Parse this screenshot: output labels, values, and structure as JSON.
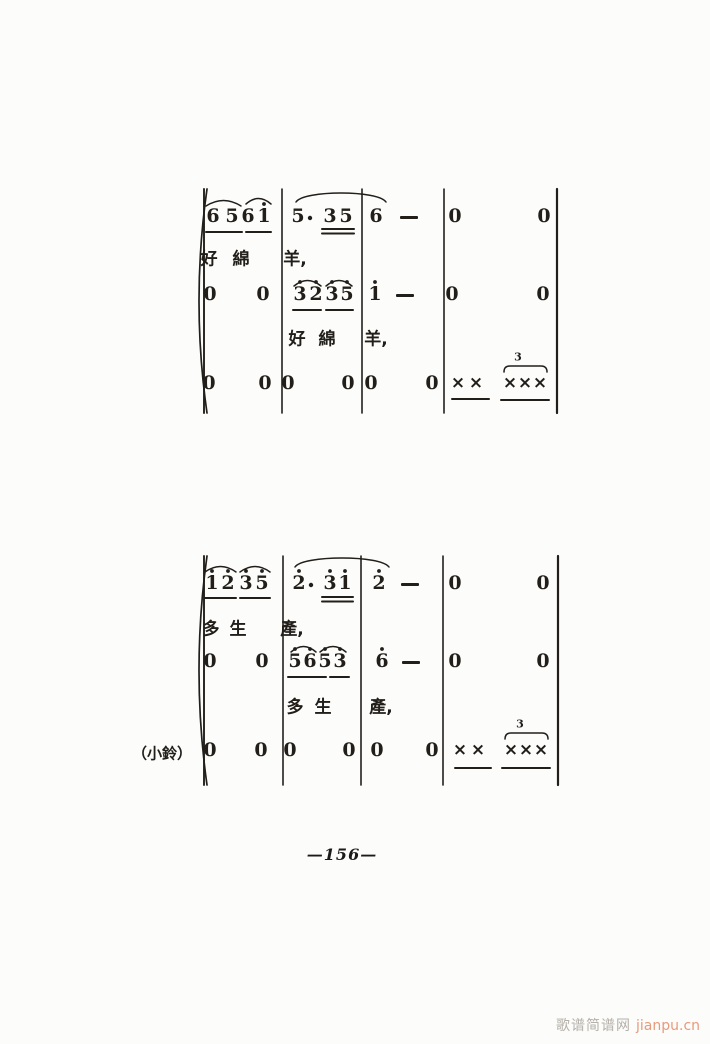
{
  "page": {
    "background": "#fcfcfa",
    "ink": "#221f1b",
    "page_number": "—156—",
    "watermark": {
      "site_name": "歌谱简谱网",
      "site_url": "jianpu.cn",
      "name_color": "#b5b0a9",
      "url_color": "#e89a7c"
    }
  },
  "systems": [
    {
      "name": "system-1",
      "top": 189,
      "bottom": 413,
      "brace_x": 196,
      "line_x": 204,
      "right_x": 557,
      "barlines": [
        282,
        362,
        444
      ],
      "label": null,
      "note_rows": [
        {
          "y": 216,
          "notes": [
            {
              "t": "6",
              "x": 213
            },
            {
              "t": "5",
              "x": 232
            },
            {
              "t": "6",
              "x": 248
            },
            {
              "t": "1",
              "x": 264,
              "d": true
            },
            {
              "t": "5",
              "x": 298,
              "aug": true
            },
            {
              "t": "3",
              "x": 330
            },
            {
              "t": "5",
              "x": 346
            },
            {
              "t": "6",
              "x": 376
            },
            {
              "t": "0",
              "x": 455
            },
            {
              "t": "0",
              "x": 544
            }
          ]
        },
        {
          "y": 294,
          "notes": [
            {
              "t": "0",
              "x": 210
            },
            {
              "t": "0",
              "x": 263
            },
            {
              "t": "3",
              "x": 300,
              "d": true
            },
            {
              "t": "2",
              "x": 316,
              "d": true
            },
            {
              "t": "3",
              "x": 332,
              "d": true
            },
            {
              "t": "5",
              "x": 347,
              "d": true
            },
            {
              "t": "1",
              "x": 375,
              "d": true
            },
            {
              "t": "0",
              "x": 452
            },
            {
              "t": "0",
              "x": 543
            }
          ]
        },
        {
          "y": 383,
          "notes": [
            {
              "t": "0",
              "x": 209
            },
            {
              "t": "0",
              "x": 265
            },
            {
              "t": "0",
              "x": 288
            },
            {
              "t": "0",
              "x": 348
            },
            {
              "t": "0",
              "x": 371
            },
            {
              "t": "0",
              "x": 432
            },
            {
              "t": "×",
              "x": 458
            },
            {
              "t": "×",
              "x": 476
            },
            {
              "t": "×",
              "x": 510
            },
            {
              "t": "×",
              "x": 525
            },
            {
              "t": "×",
              "x": 540
            }
          ]
        }
      ],
      "dashes": [
        {
          "x": 409,
          "y": 216
        },
        {
          "x": 405,
          "y": 294
        }
      ],
      "lyric_rows": [
        {
          "y": 257,
          "chars": [
            {
              "t": "好",
              "x": 209
            },
            {
              "t": "綿",
              "x": 241
            },
            {
              "t": "羊,",
              "x": 295
            }
          ]
        },
        {
          "y": 337,
          "chars": [
            {
              "t": "好",
              "x": 297
            },
            {
              "t": "綿",
              "x": 327
            },
            {
              "t": "羊,",
              "x": 376
            }
          ]
        }
      ],
      "slurs": [
        {
          "x1": 206,
          "x2": 241,
          "y": 197
        },
        {
          "x1": 246,
          "x2": 271,
          "y": 195
        },
        {
          "x1": 296,
          "x2": 386,
          "y": 190,
          "big": true
        },
        {
          "x1": 294,
          "x2": 321,
          "y": 277
        },
        {
          "x1": 326,
          "x2": 352,
          "y": 277
        }
      ],
      "underlines": [
        {
          "x1": 206,
          "x2": 242,
          "y": 232
        },
        {
          "x1": 246,
          "x2": 271,
          "y": 232
        },
        {
          "x1": 322,
          "x2": 354,
          "y": 229,
          "n": 2
        },
        {
          "x1": 293,
          "x2": 321,
          "y": 310
        },
        {
          "x1": 326,
          "x2": 353,
          "y": 310
        },
        {
          "x1": 452,
          "x2": 489,
          "y": 399
        },
        {
          "x1": 501,
          "x2": 549,
          "y": 400
        }
      ],
      "triplets": [
        {
          "x1": 504,
          "x2": 547,
          "y": 366,
          "label": "3",
          "lx": 518,
          "ly": 357
        }
      ]
    },
    {
      "name": "system-2",
      "top": 556,
      "bottom": 785,
      "brace_x": 196,
      "line_x": 204,
      "right_x": 558,
      "barlines": [
        283,
        361,
        443
      ],
      "label": {
        "text": "（小鈴）",
        "x": 162,
        "y": 753
      },
      "note_rows": [
        {
          "y": 583,
          "notes": [
            {
              "t": "1",
              "x": 212,
              "d": true
            },
            {
              "t": "2",
              "x": 228,
              "d": true
            },
            {
              "t": "3",
              "x": 246,
              "d": true
            },
            {
              "t": "5",
              "x": 262,
              "d": true
            },
            {
              "t": "2",
              "x": 299,
              "d": true,
              "aug": true
            },
            {
              "t": "3",
              "x": 330,
              "d": true
            },
            {
              "t": "1",
              "x": 345,
              "d": true
            },
            {
              "t": "2",
              "x": 379,
              "d": true
            },
            {
              "t": "0",
              "x": 455
            },
            {
              "t": "0",
              "x": 543
            }
          ]
        },
        {
          "y": 661,
          "notes": [
            {
              "t": "0",
              "x": 210
            },
            {
              "t": "0",
              "x": 262
            },
            {
              "t": "5",
              "x": 295,
              "d": true
            },
            {
              "t": "6",
              "x": 310,
              "d": true
            },
            {
              "t": "5",
              "x": 325,
              "d": true
            },
            {
              "t": "3",
              "x": 340,
              "d": true
            },
            {
              "t": "6",
              "x": 382,
              "d": true
            },
            {
              "t": "0",
              "x": 455
            },
            {
              "t": "0",
              "x": 543
            }
          ]
        },
        {
          "y": 750,
          "notes": [
            {
              "t": "0",
              "x": 210
            },
            {
              "t": "0",
              "x": 261
            },
            {
              "t": "0",
              "x": 290
            },
            {
              "t": "0",
              "x": 349
            },
            {
              "t": "0",
              "x": 377
            },
            {
              "t": "0",
              "x": 432
            },
            {
              "t": "×",
              "x": 460
            },
            {
              "t": "×",
              "x": 478
            },
            {
              "t": "×",
              "x": 511
            },
            {
              "t": "×",
              "x": 526
            },
            {
              "t": "×",
              "x": 541
            }
          ]
        }
      ],
      "dashes": [
        {
          "x": 410,
          "y": 583
        },
        {
          "x": 411,
          "y": 661
        }
      ],
      "lyric_rows": [
        {
          "y": 627,
          "chars": [
            {
              "t": "多",
              "x": 211
            },
            {
              "t": "生",
              "x": 238
            },
            {
              "t": "產,",
              "x": 292
            }
          ]
        },
        {
          "y": 705,
          "chars": [
            {
              "t": "多",
              "x": 295
            },
            {
              "t": "生",
              "x": 323
            },
            {
              "t": "產,",
              "x": 381
            }
          ]
        }
      ],
      "slurs": [
        {
          "x1": 205,
          "x2": 236,
          "y": 563
        },
        {
          "x1": 240,
          "x2": 270,
          "y": 563
        },
        {
          "x1": 295,
          "x2": 389,
          "y": 555,
          "big": true
        },
        {
          "x1": 291,
          "x2": 316,
          "y": 643
        },
        {
          "x1": 320,
          "x2": 346,
          "y": 643
        }
      ],
      "underlines": [
        {
          "x1": 205,
          "x2": 236,
          "y": 598
        },
        {
          "x1": 240,
          "x2": 270,
          "y": 598
        },
        {
          "x1": 322,
          "x2": 353,
          "y": 597,
          "n": 2
        },
        {
          "x1": 288,
          "x2": 326,
          "y": 677
        },
        {
          "x1": 330,
          "x2": 349,
          "y": 677
        },
        {
          "x1": 455,
          "x2": 491,
          "y": 768
        },
        {
          "x1": 502,
          "x2": 550,
          "y": 768
        }
      ],
      "triplets": [
        {
          "x1": 505,
          "x2": 548,
          "y": 733,
          "label": "3",
          "lx": 520,
          "ly": 724
        }
      ]
    }
  ]
}
